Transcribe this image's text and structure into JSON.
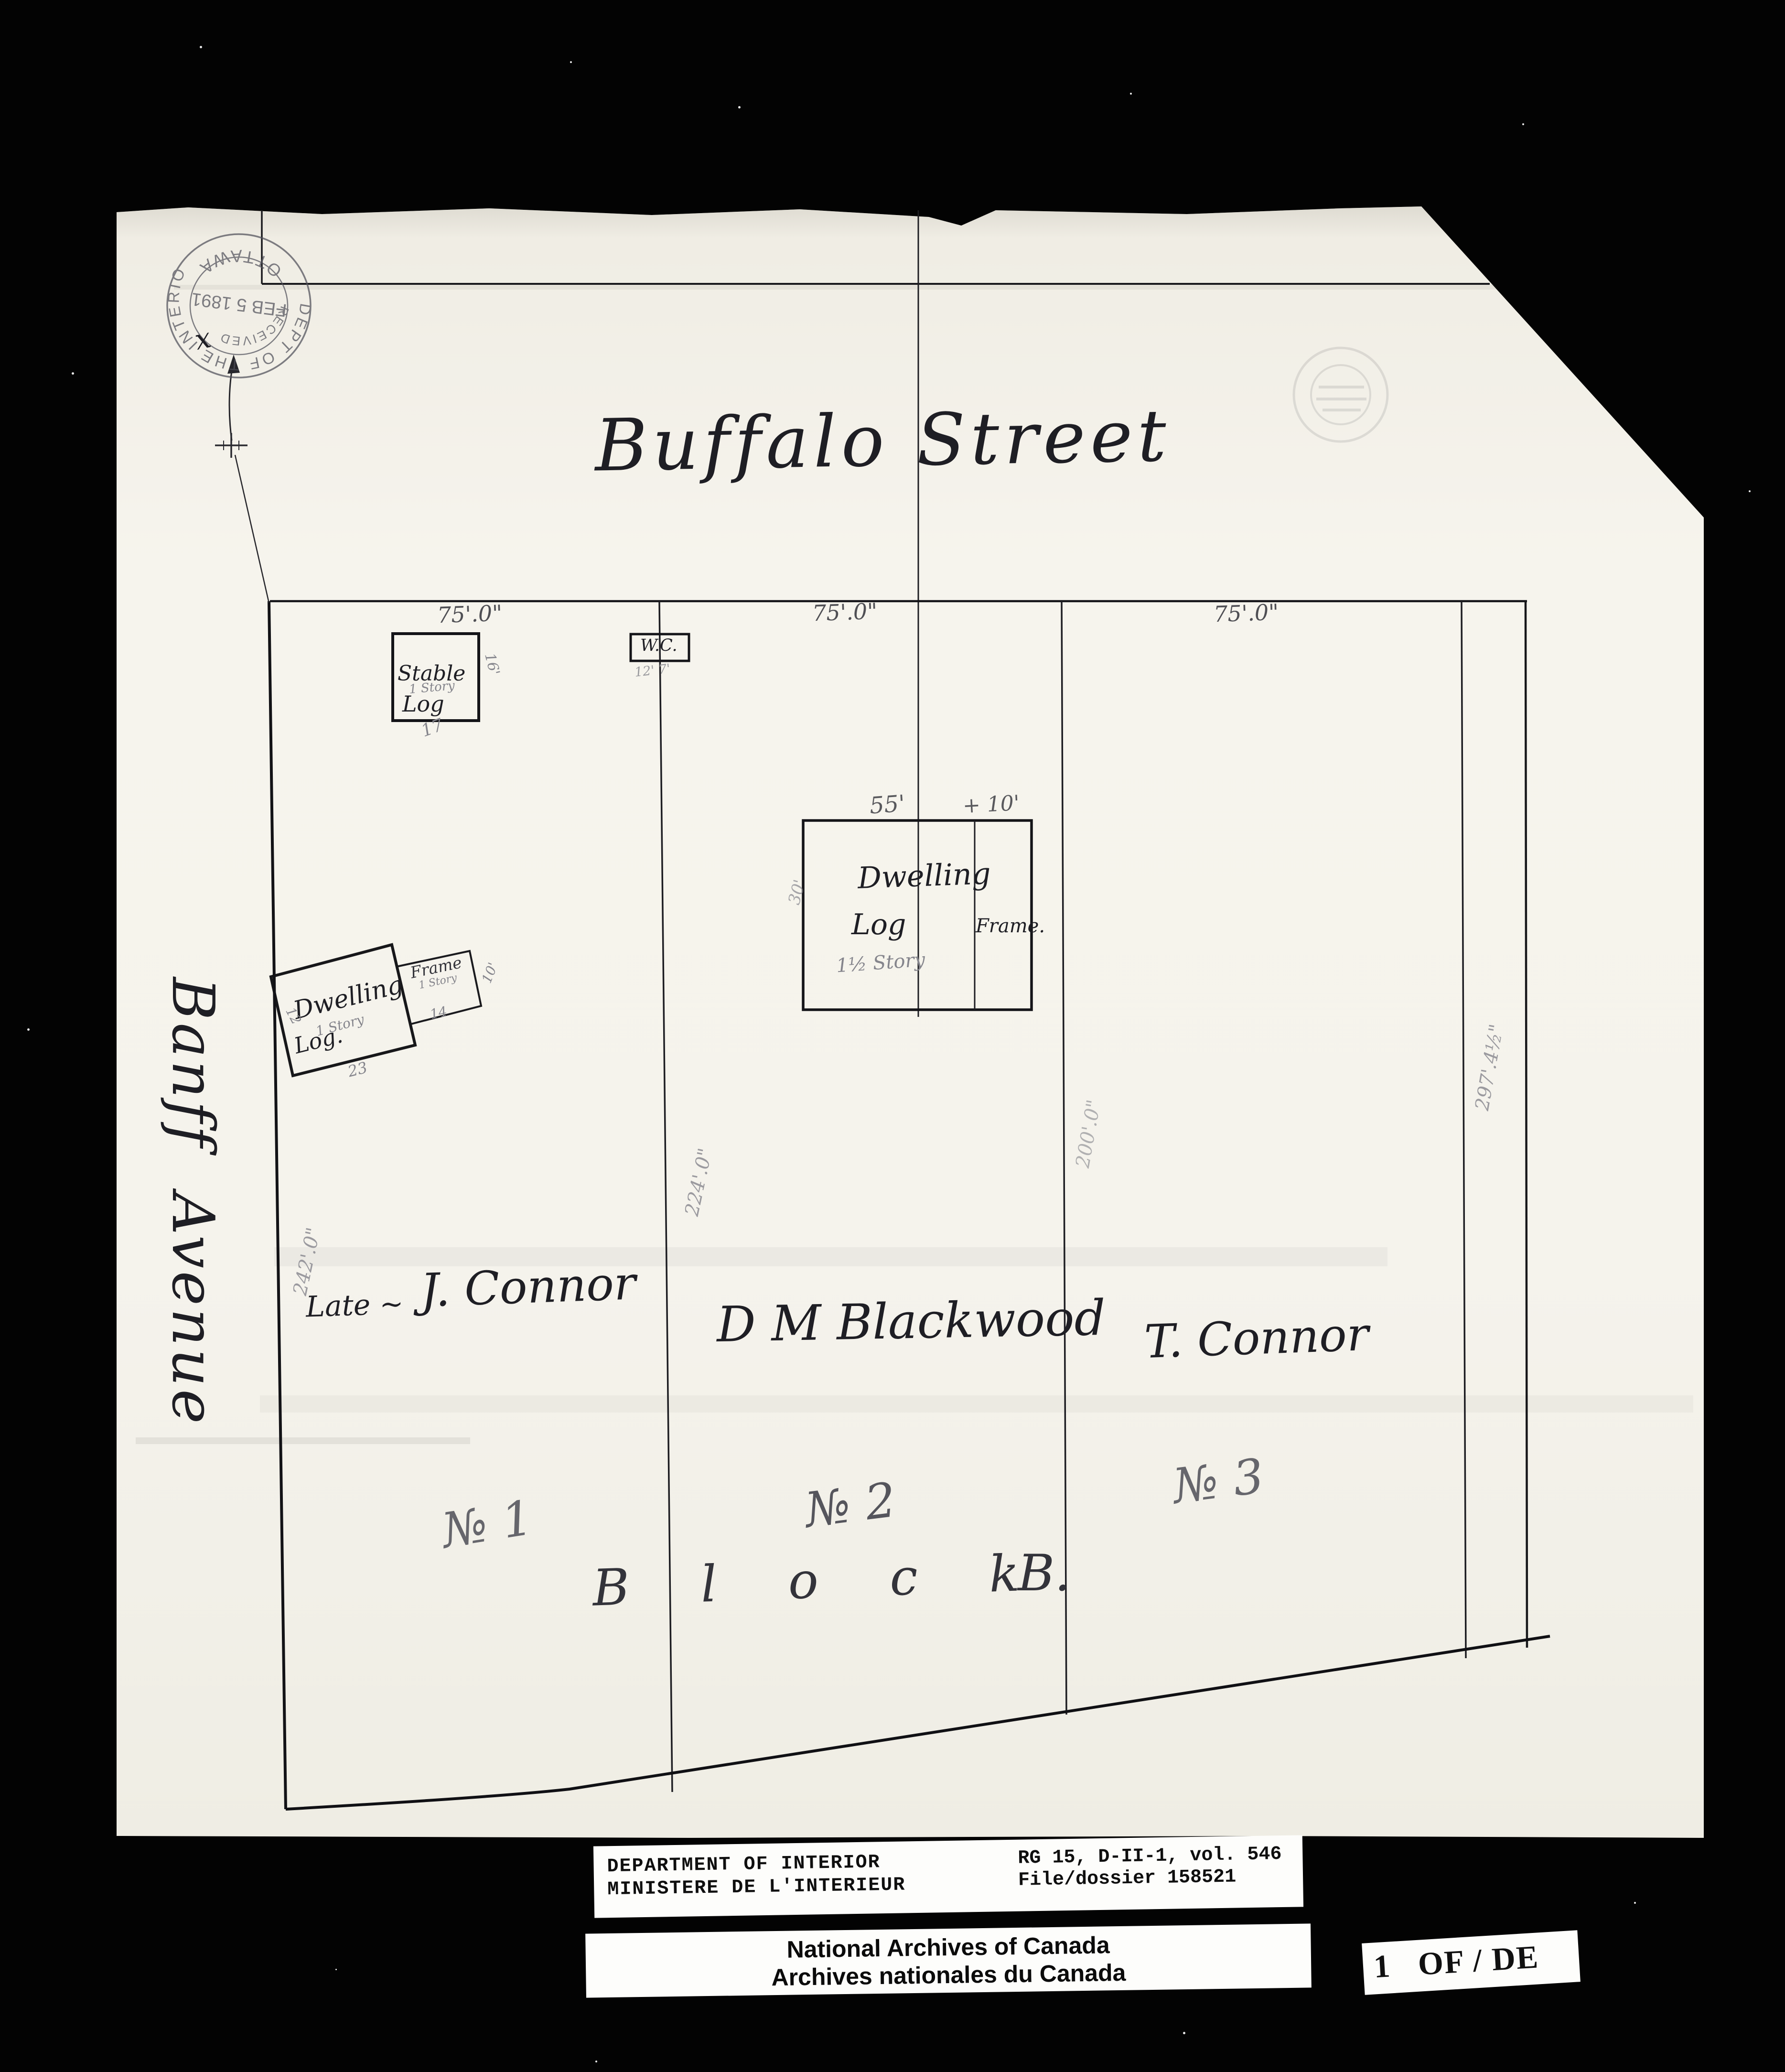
{
  "scan": {
    "street": "Buffalo Street",
    "avenue": "Banff  Avenue",
    "stamp": {
      "ring_top": "DEPT OF THE INTERIOR",
      "ring_bottom": "OTTAWA",
      "line_received": "RECEIVED",
      "line_date": "FEB 5 1891",
      "annotation": "x"
    },
    "frontage_labels": [
      "75'.0\"",
      "75'.0\"",
      "75'.0\""
    ],
    "depth_labels": {
      "west": "242'.0\"",
      "lot1": "224'.0\"",
      "lot2": "200'.0\"",
      "lot3": "297'.4½\""
    },
    "owners": {
      "lot1_prefix": "Late ~",
      "lot1": "J. Connor",
      "lot2": "D M Blackwood",
      "lot3": "T. Connor"
    },
    "lot_numbers": {
      "lot1": "№ 1",
      "lot2": "№ 2",
      "lot3": "№ 3"
    },
    "block": {
      "spread": "B l o c k",
      "letter": "B."
    },
    "buildings": {
      "stable": {
        "name": "Stable",
        "story": "1 Story",
        "material": "Log",
        "dim_bottom": "17",
        "dim_side": "16'"
      },
      "wc": {
        "name": "W.C.",
        "dims": "12' 7'"
      },
      "dwelling2": {
        "name": "Dwelling",
        "material": "Log",
        "story": "1½ Story",
        "wing": "Frame.",
        "dim_top_main": "55'",
        "dim_top_wing": "+ 10'",
        "dim_side": "30'"
      },
      "dwelling1": {
        "name": "Dwelling",
        "story": "1 Story",
        "material": "Log.",
        "dim_bottom": "23",
        "dim_side": "12"
      },
      "dwelling1_wing": {
        "name": "Frame",
        "story": "1 Story",
        "dim_side": "10'",
        "dim_bottom": "14"
      }
    }
  },
  "footer": {
    "dept_en": "DEPARTMENT OF INTERIOR",
    "dept_fr": "MINISTERE DE L'INTERIEUR",
    "ref_line1": "RG 15, D-II-1, vol. 546",
    "ref_line2": "File/dossier 158521",
    "archives_en": "National Archives of Canada",
    "archives_fr": "Archives nationales du Canada",
    "page": "1   OF / DE"
  },
  "colors": {
    "paper": "#f5f3ec",
    "ink": "#1e1e24",
    "pencil": "#85858c",
    "stamp": "#50505a"
  }
}
